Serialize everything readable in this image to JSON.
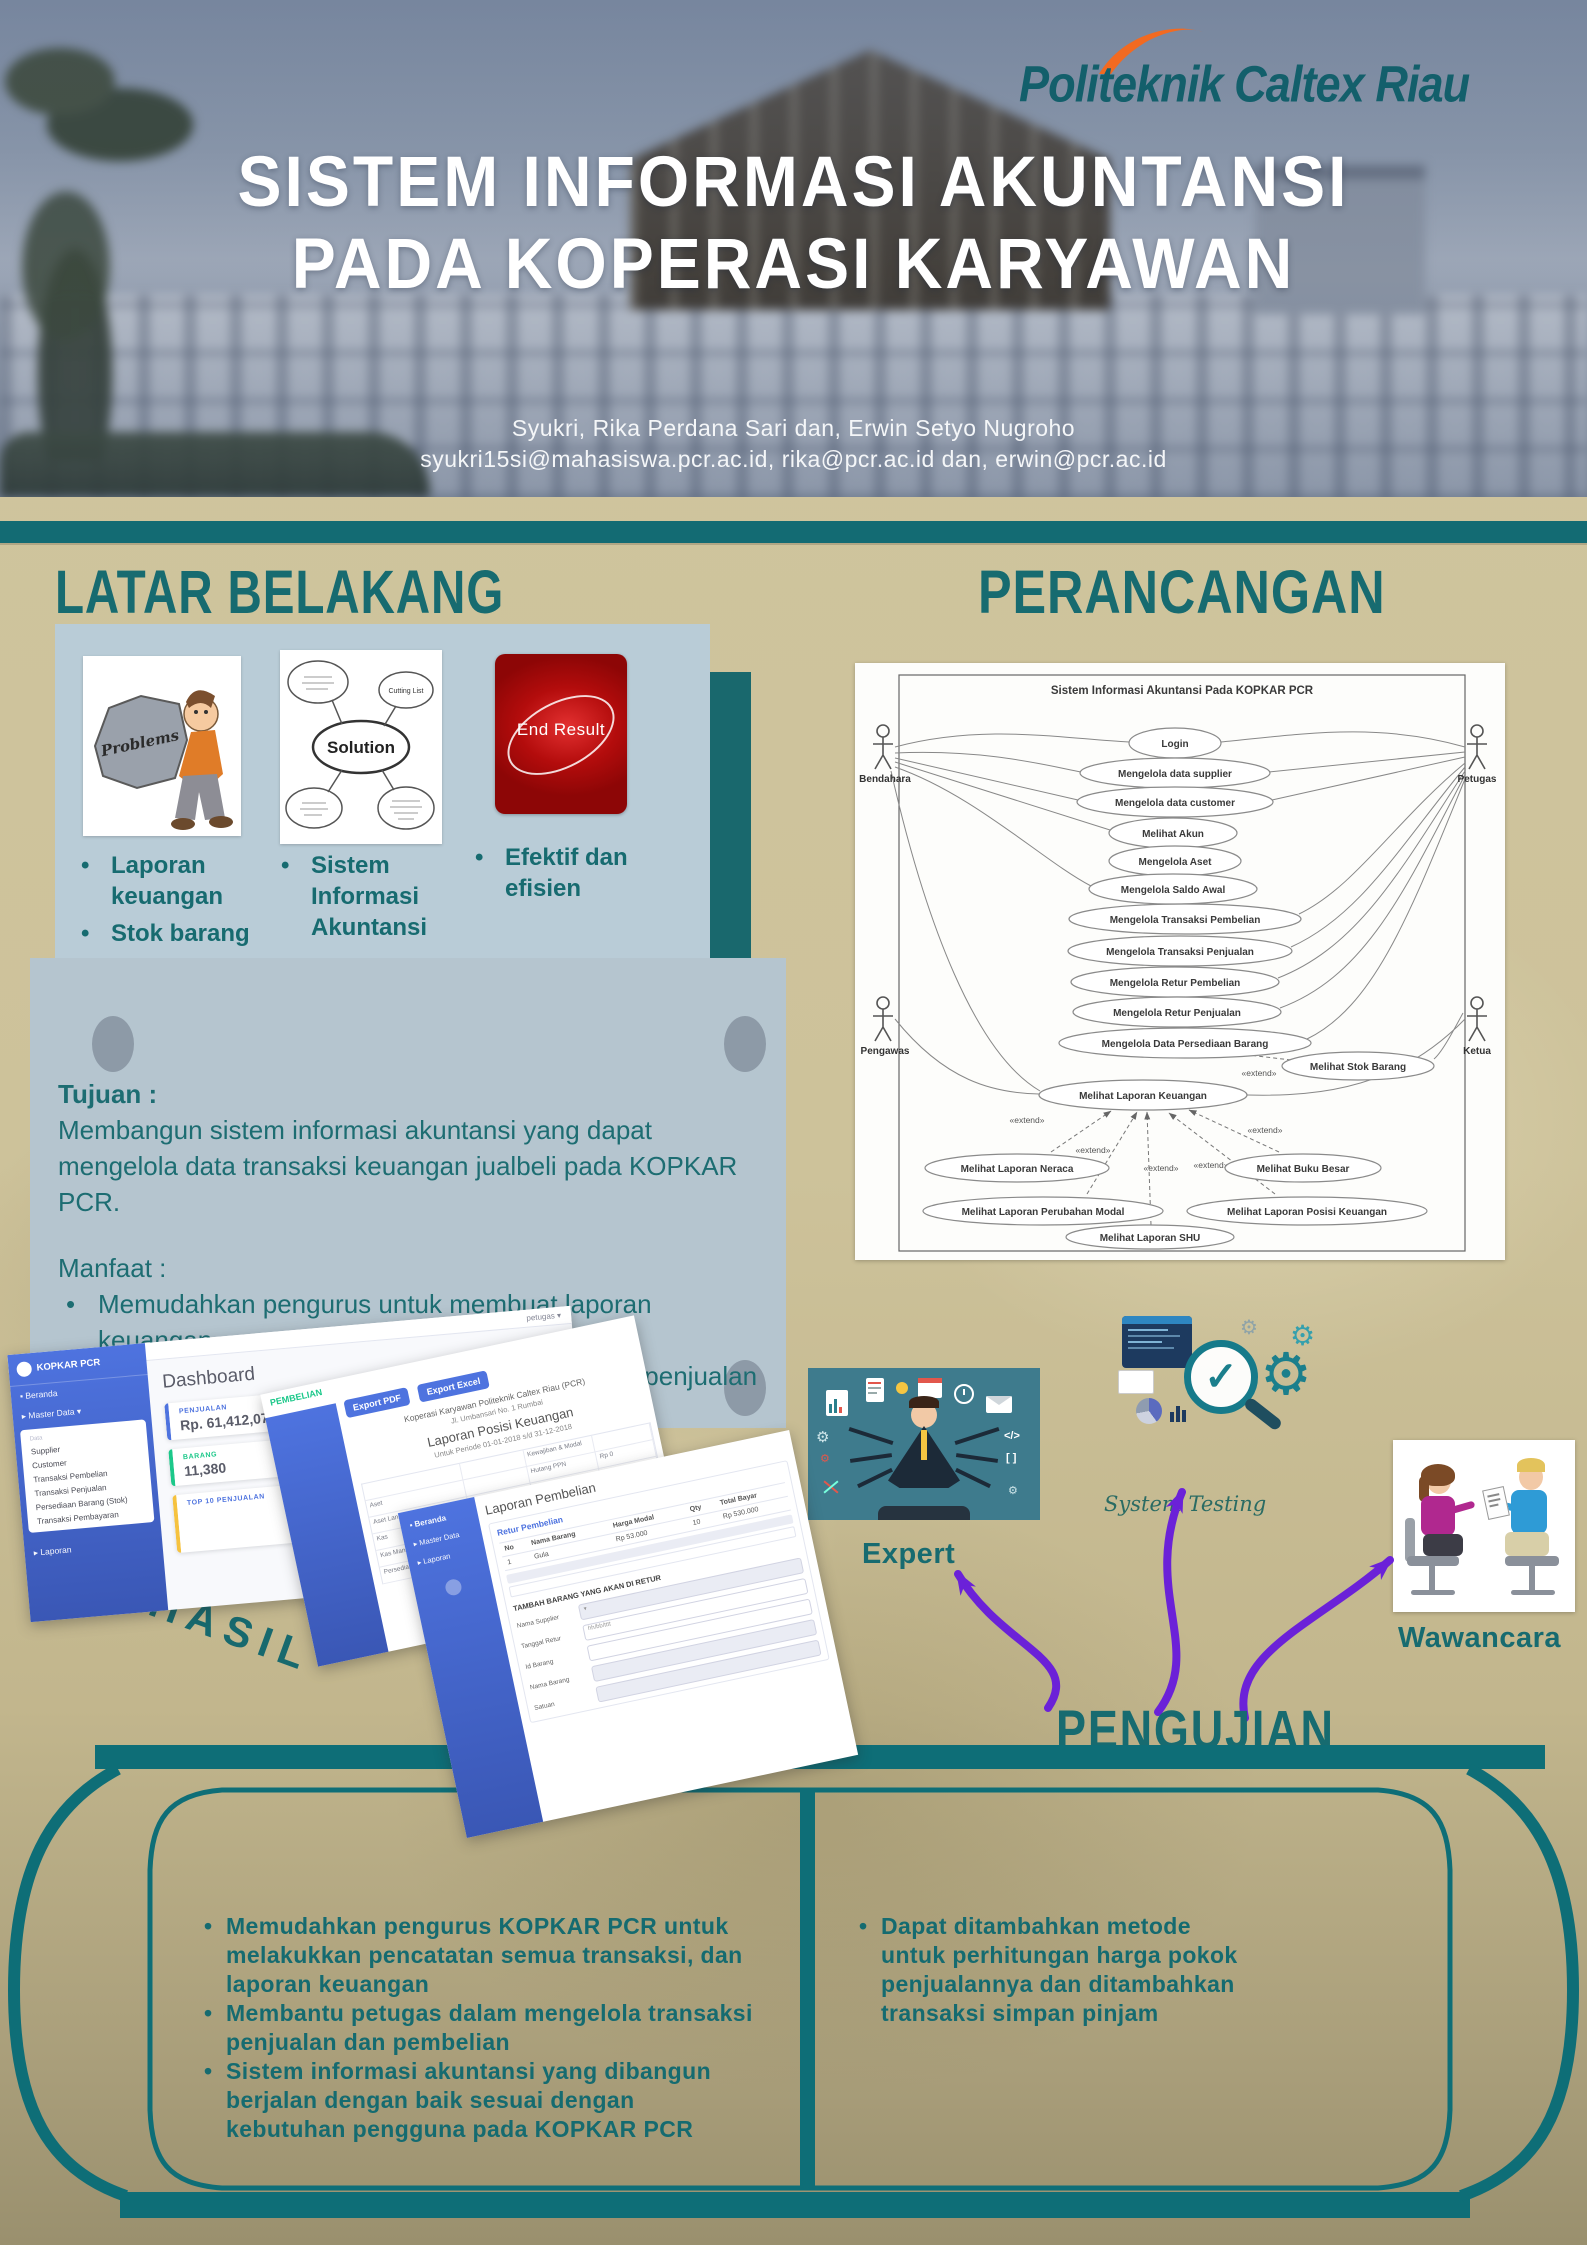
{
  "poster": {
    "logo_text": "Politeknik Caltex Riau",
    "title_line1": "SISTEM INFORMASI AKUNTANSI",
    "title_line2": "PADA KOPERASI KARYAWAN",
    "authors": "Syukri, Rika Perdana Sari dan, Erwin Setyo Nugroho",
    "emails": "syukri15si@mahasiswa.pcr.ac.id, rika@pcr.ac.id dan, erwin@pcr.ac.id"
  },
  "latar_belakang": {
    "heading": "LATAR BELAKANG",
    "problems_label": "Problems",
    "solution_label": "Solution",
    "solution_bubble": "Cutting List",
    "end_result_label": "End Result",
    "bullets_col1": [
      "Laporan keuangan",
      "Stok barang"
    ],
    "bullets_col2": [
      "Sistem Informasi Akuntansi"
    ],
    "bullets_col3": [
      "Efektif dan efisien"
    ]
  },
  "tujuan": {
    "heading": "Tujuan :",
    "body": "Membangun sistem informasi akuntansi yang dapat mengelola data transaksi keuangan jualbeli pada KOPKAR PCR.",
    "manfaat_heading": "Manfaat :",
    "manfaat": [
      "Memudahkan pengurus untuk membuat laporan keuangan.",
      "Membantu petugas dalam mengelola transaksi penjualan dan pembelian."
    ]
  },
  "perancangan": {
    "heading": "PERANCANGAN",
    "diagram_title": "Sistem Informasi Akuntansi Pada KOPKAR PCR",
    "actors": [
      "Bendahara",
      "Pengawas",
      "Petugas",
      "Ketua"
    ],
    "extend_label": "«extend»",
    "use_cases": [
      "Login",
      "Mengelola data supplier",
      "Mengelola data customer",
      "Melihat Akun",
      "Mengelola Aset",
      "Mengelola Saldo Awal",
      "Mengelola Transaksi Pembelian",
      "Mengelola Transaksi Penjualan",
      "Mengelola Retur Pembelian",
      "Mengelola Retur Penjualan",
      "Mengelola Data Persediaan Barang",
      "Melihat Stok Barang",
      "Melihat Laporan Keuangan",
      "Melihat Laporan Neraca",
      "Melihat Buku Besar",
      "Melihat Laporan Perubahan Modal",
      "Melihat Laporan Posisi Keuangan",
      "Melihat Laporan SHU"
    ]
  },
  "hasil": {
    "heading": "HASIL",
    "dashboard": {
      "brand": "KOPKAR PCR",
      "user": "petugas",
      "menu_home": "Beranda",
      "menu_master": "Master Data",
      "submenu": [
        "Data",
        "Supplier",
        "Customer",
        "Transaksi Pembelian",
        "Transaksi Penjualan",
        "Persediaan Barang (Stok)",
        "Transaksi Pembayaran"
      ],
      "menu_laporan": "Laporan",
      "page_title": "Dashboard",
      "card1_label": "PENJUALAN",
      "card1_value": "Rp. 61,412,072",
      "card2_label": "BARANG",
      "card2_value": "11,380",
      "card3_label": "TOP 10 PENJUALAN"
    },
    "laporan_posisi": {
      "tag": "PEMBELIAN",
      "btn_pdf": "Export PDF",
      "btn_excel": "Export Excel",
      "org": "Koperasi Karyawan Politeknik Caltex Riau (PCR)",
      "address": "Jl. Umbansari No. 1 Rumbai",
      "title": "Laporan Posisi Keuangan",
      "period": "Untuk Periode 01-01-2018 s/d 31-12-2018",
      "row_labels": [
        "Aset",
        "Aset Lancar",
        "Kas",
        "Kas Mandiri Unit Dagang",
        "Persediaan Barang Dagang"
      ],
      "col_kewajiban": "Kewajiban & Modal",
      "hutang": "Hutang PPN",
      "rp0": "Rp 0",
      "rp": "Rp",
      "saldo": "8.041.572"
    },
    "laporan_pembelian": {
      "sidebar": [
        "Beranda",
        "Master Data",
        "Laporan"
      ],
      "title": "Laporan Pembelian",
      "link": "Retur Pembelian",
      "headers": [
        "No",
        "Nama Barang",
        "Harga Modal",
        "Qty",
        "Total Bayar"
      ],
      "row": [
        "1",
        "Gula",
        "Rp 53.000",
        "10",
        "Rp 530.000"
      ],
      "form_title": "TAMBAH BARANG YANG AKAN DI RETUR",
      "fields": [
        "Nama Supplier",
        "Tanggal Retur",
        "Id Barang",
        "Nama Barang",
        "Satuan"
      ],
      "date_placeholder": "hh/bb/tttt"
    }
  },
  "pengujian": {
    "heading": "PENGUJIAN",
    "expert_label": "Expert",
    "system_testing_label": "System Testing",
    "wawancara_label": "Wawancara"
  },
  "kesimpulan": {
    "left": [
      "Memudahkan pengurus KOPKAR PCR untuk melakukkan pencatatan semua transaksi, dan laporan keuangan",
      "Membantu petugas dalam mengelola transaksi penjualan dan pembelian",
      "Sistem informasi akuntansi yang dibangun berjalan dengan baik sesuai dengan kebutuhan pengguna pada KOPKAR PCR"
    ],
    "right": [
      "Dapat ditambahkan metode untuk perhitungan harga pokok penjualannya dan ditambahkan transaksi simpan pinjam"
    ]
  },
  "colors": {
    "teal": "#176b70",
    "frame_teal": "#0e6e77",
    "accent_blue": "#4e73df",
    "purple": "#6b21d8",
    "orange_swoosh": "#f26a21",
    "card_bg": "#b9ccd7",
    "tan_bg": "#cbc099"
  }
}
